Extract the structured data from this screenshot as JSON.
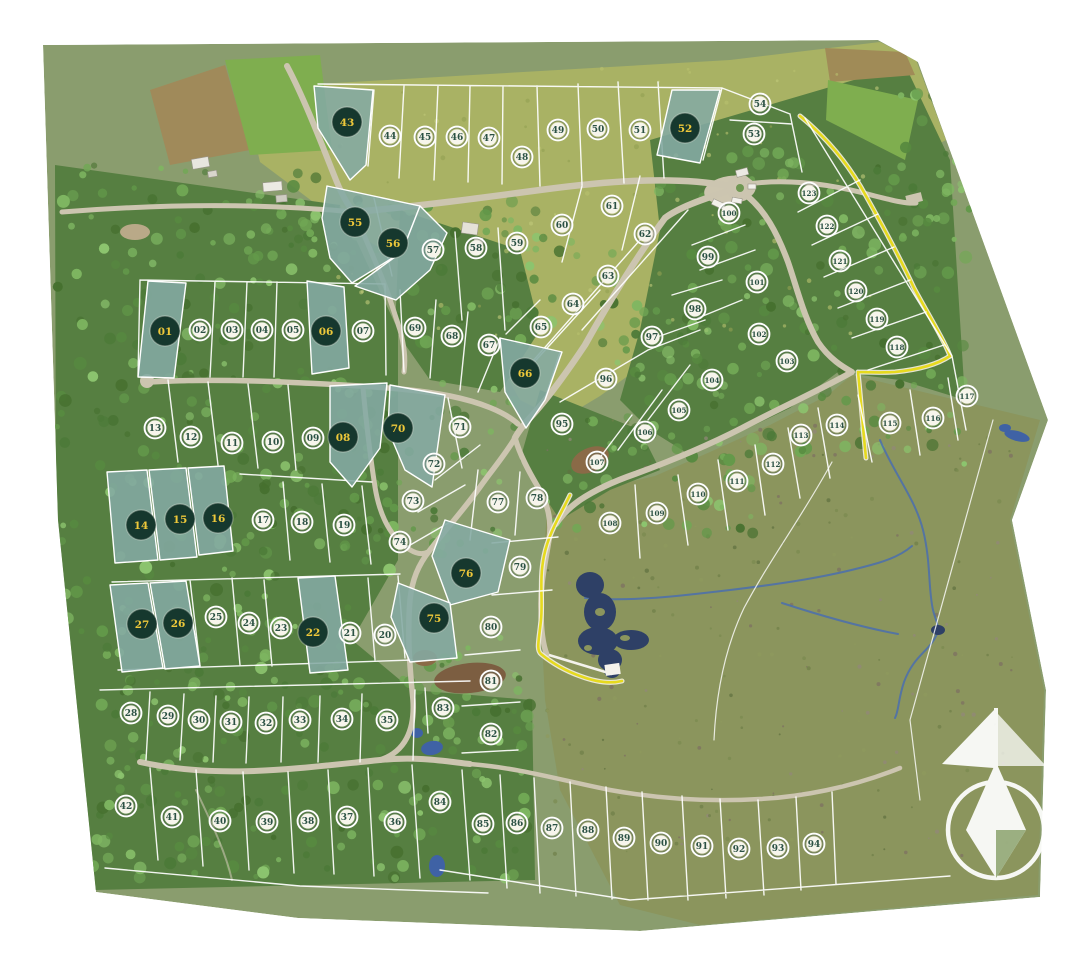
{
  "map": {
    "name": "aerial-subdivision-masterplan",
    "compass_icon": "compass-north-rose",
    "marker_styles": {
      "available": "white circle with dark green lot number",
      "sold": "dark green circle with yellow lot number on teal shaded lot"
    }
  },
  "colors": {
    "sold_overlay": "#84aaa3",
    "sold_marker": "#16382e",
    "sold_number": "#eec83a",
    "available_marker": "#f7f5ec",
    "available_number": "#2b5144",
    "trail": "#e6da1e",
    "water": "#2e4066",
    "stream": "#4a6fae",
    "base_green": "#8a9d6e",
    "forest_green": "#567f41",
    "pasture_green": "#a9b264",
    "moor_green": "#8b955d",
    "road_grey": "#ccc5b0"
  },
  "lots": [
    {
      "id": "01",
      "x": 165,
      "y": 331,
      "status": "sold"
    },
    {
      "id": "02",
      "x": 200,
      "y": 330,
      "status": "available"
    },
    {
      "id": "03",
      "x": 232,
      "y": 330,
      "status": "available"
    },
    {
      "id": "04",
      "x": 262,
      "y": 330,
      "status": "available"
    },
    {
      "id": "05",
      "x": 293,
      "y": 330,
      "status": "available"
    },
    {
      "id": "06",
      "x": 326,
      "y": 331,
      "status": "sold"
    },
    {
      "id": "07",
      "x": 363,
      "y": 331,
      "status": "available"
    },
    {
      "id": "08",
      "x": 343,
      "y": 437,
      "status": "sold"
    },
    {
      "id": "09",
      "x": 313,
      "y": 438,
      "status": "available"
    },
    {
      "id": "10",
      "x": 273,
      "y": 442,
      "status": "available"
    },
    {
      "id": "11",
      "x": 232,
      "y": 443,
      "status": "available"
    },
    {
      "id": "12",
      "x": 191,
      "y": 437,
      "status": "available"
    },
    {
      "id": "13",
      "x": 155,
      "y": 428,
      "status": "available"
    },
    {
      "id": "14",
      "x": 141,
      "y": 525,
      "status": "sold"
    },
    {
      "id": "15",
      "x": 180,
      "y": 519,
      "status": "sold"
    },
    {
      "id": "16",
      "x": 218,
      "y": 518,
      "status": "sold"
    },
    {
      "id": "17",
      "x": 263,
      "y": 520,
      "status": "available"
    },
    {
      "id": "18",
      "x": 302,
      "y": 522,
      "status": "available"
    },
    {
      "id": "19",
      "x": 344,
      "y": 525,
      "status": "available"
    },
    {
      "id": "20",
      "x": 385,
      "y": 635,
      "status": "available"
    },
    {
      "id": "21",
      "x": 350,
      "y": 633,
      "status": "available"
    },
    {
      "id": "22",
      "x": 313,
      "y": 632,
      "status": "sold"
    },
    {
      "id": "23",
      "x": 281,
      "y": 628,
      "status": "available"
    },
    {
      "id": "24",
      "x": 249,
      "y": 623,
      "status": "available"
    },
    {
      "id": "25",
      "x": 216,
      "y": 617,
      "status": "available"
    },
    {
      "id": "26",
      "x": 178,
      "y": 623,
      "status": "sold"
    },
    {
      "id": "27",
      "x": 142,
      "y": 624,
      "status": "sold"
    },
    {
      "id": "28",
      "x": 131,
      "y": 713,
      "status": "available"
    },
    {
      "id": "29",
      "x": 168,
      "y": 716,
      "status": "available"
    },
    {
      "id": "30",
      "x": 199,
      "y": 720,
      "status": "available"
    },
    {
      "id": "31",
      "x": 231,
      "y": 722,
      "status": "available"
    },
    {
      "id": "32",
      "x": 266,
      "y": 723,
      "status": "available"
    },
    {
      "id": "33",
      "x": 300,
      "y": 720,
      "status": "available"
    },
    {
      "id": "34",
      "x": 342,
      "y": 719,
      "status": "available"
    },
    {
      "id": "35",
      "x": 387,
      "y": 720,
      "status": "available"
    },
    {
      "id": "36",
      "x": 395,
      "y": 822,
      "status": "available"
    },
    {
      "id": "37",
      "x": 347,
      "y": 817,
      "status": "available"
    },
    {
      "id": "38",
      "x": 308,
      "y": 821,
      "status": "available"
    },
    {
      "id": "39",
      "x": 267,
      "y": 822,
      "status": "available"
    },
    {
      "id": "40",
      "x": 220,
      "y": 821,
      "status": "available"
    },
    {
      "id": "41",
      "x": 172,
      "y": 817,
      "status": "available"
    },
    {
      "id": "42",
      "x": 126,
      "y": 806,
      "status": "available"
    },
    {
      "id": "43",
      "x": 347,
      "y": 122,
      "status": "sold"
    },
    {
      "id": "44",
      "x": 390,
      "y": 136,
      "status": "available"
    },
    {
      "id": "45",
      "x": 425,
      "y": 137,
      "status": "available"
    },
    {
      "id": "46",
      "x": 457,
      "y": 137,
      "status": "available"
    },
    {
      "id": "47",
      "x": 489,
      "y": 138,
      "status": "available"
    },
    {
      "id": "48",
      "x": 522,
      "y": 157,
      "status": "available"
    },
    {
      "id": "49",
      "x": 558,
      "y": 130,
      "status": "available"
    },
    {
      "id": "50",
      "x": 598,
      "y": 129,
      "status": "available"
    },
    {
      "id": "51",
      "x": 640,
      "y": 130,
      "status": "available"
    },
    {
      "id": "52",
      "x": 685,
      "y": 128,
      "status": "sold"
    },
    {
      "id": "53",
      "x": 754,
      "y": 134,
      "status": "available"
    },
    {
      "id": "54",
      "x": 760,
      "y": 104,
      "status": "available"
    },
    {
      "id": "55",
      "x": 355,
      "y": 222,
      "status": "sold"
    },
    {
      "id": "56",
      "x": 393,
      "y": 243,
      "status": "sold"
    },
    {
      "id": "57",
      "x": 433,
      "y": 250,
      "status": "available"
    },
    {
      "id": "58",
      "x": 476,
      "y": 248,
      "status": "available"
    },
    {
      "id": "59",
      "x": 517,
      "y": 243,
      "status": "available"
    },
    {
      "id": "60",
      "x": 562,
      "y": 225,
      "status": "available"
    },
    {
      "id": "61",
      "x": 612,
      "y": 206,
      "status": "available"
    },
    {
      "id": "62",
      "x": 645,
      "y": 234,
      "status": "available"
    },
    {
      "id": "63",
      "x": 608,
      "y": 276,
      "status": "available"
    },
    {
      "id": "64",
      "x": 573,
      "y": 304,
      "status": "available"
    },
    {
      "id": "65",
      "x": 541,
      "y": 327,
      "status": "available"
    },
    {
      "id": "66",
      "x": 525,
      "y": 373,
      "status": "sold"
    },
    {
      "id": "67",
      "x": 489,
      "y": 345,
      "status": "available"
    },
    {
      "id": "68",
      "x": 452,
      "y": 336,
      "status": "available"
    },
    {
      "id": "69",
      "x": 415,
      "y": 328,
      "status": "available"
    },
    {
      "id": "70",
      "x": 398,
      "y": 428,
      "status": "sold"
    },
    {
      "id": "71",
      "x": 460,
      "y": 427,
      "status": "available"
    },
    {
      "id": "72",
      "x": 434,
      "y": 464,
      "status": "available"
    },
    {
      "id": "73",
      "x": 413,
      "y": 501,
      "status": "available"
    },
    {
      "id": "74",
      "x": 400,
      "y": 542,
      "status": "available"
    },
    {
      "id": "75",
      "x": 434,
      "y": 618,
      "status": "sold"
    },
    {
      "id": "76",
      "x": 466,
      "y": 573,
      "status": "sold"
    },
    {
      "id": "77",
      "x": 498,
      "y": 502,
      "status": "available"
    },
    {
      "id": "78",
      "x": 537,
      "y": 498,
      "status": "available"
    },
    {
      "id": "79",
      "x": 520,
      "y": 567,
      "status": "available"
    },
    {
      "id": "80",
      "x": 491,
      "y": 627,
      "status": "available"
    },
    {
      "id": "81",
      "x": 491,
      "y": 681,
      "status": "available"
    },
    {
      "id": "82",
      "x": 491,
      "y": 734,
      "status": "available"
    },
    {
      "id": "83",
      "x": 443,
      "y": 708,
      "status": "available"
    },
    {
      "id": "84",
      "x": 440,
      "y": 802,
      "status": "available"
    },
    {
      "id": "85",
      "x": 483,
      "y": 824,
      "status": "available"
    },
    {
      "id": "86",
      "x": 517,
      "y": 823,
      "status": "available"
    },
    {
      "id": "87",
      "x": 552,
      "y": 828,
      "status": "available"
    },
    {
      "id": "88",
      "x": 588,
      "y": 830,
      "status": "available"
    },
    {
      "id": "89",
      "x": 624,
      "y": 838,
      "status": "available"
    },
    {
      "id": "90",
      "x": 661,
      "y": 843,
      "status": "available"
    },
    {
      "id": "91",
      "x": 702,
      "y": 846,
      "status": "available"
    },
    {
      "id": "92",
      "x": 739,
      "y": 849,
      "status": "available"
    },
    {
      "id": "93",
      "x": 778,
      "y": 848,
      "status": "available"
    },
    {
      "id": "94",
      "x": 814,
      "y": 844,
      "status": "available"
    },
    {
      "id": "95",
      "x": 562,
      "y": 424,
      "status": "available"
    },
    {
      "id": "96",
      "x": 606,
      "y": 379,
      "status": "available"
    },
    {
      "id": "97",
      "x": 652,
      "y": 337,
      "status": "available"
    },
    {
      "id": "98",
      "x": 695,
      "y": 309,
      "status": "available"
    },
    {
      "id": "99",
      "x": 708,
      "y": 257,
      "status": "available"
    },
    {
      "id": "100",
      "x": 729,
      "y": 213,
      "status": "available"
    },
    {
      "id": "101",
      "x": 757,
      "y": 282,
      "status": "available"
    },
    {
      "id": "102",
      "x": 759,
      "y": 334,
      "status": "available"
    },
    {
      "id": "103",
      "x": 787,
      "y": 361,
      "status": "available"
    },
    {
      "id": "104",
      "x": 712,
      "y": 380,
      "status": "available"
    },
    {
      "id": "105",
      "x": 679,
      "y": 410,
      "status": "available"
    },
    {
      "id": "106",
      "x": 645,
      "y": 432,
      "status": "available"
    },
    {
      "id": "107",
      "x": 597,
      "y": 462,
      "status": "available"
    },
    {
      "id": "108",
      "x": 610,
      "y": 523,
      "status": "available"
    },
    {
      "id": "109",
      "x": 657,
      "y": 513,
      "status": "available"
    },
    {
      "id": "110",
      "x": 698,
      "y": 494,
      "status": "available"
    },
    {
      "id": "111",
      "x": 737,
      "y": 481,
      "status": "available"
    },
    {
      "id": "112",
      "x": 773,
      "y": 464,
      "status": "available"
    },
    {
      "id": "113",
      "x": 801,
      "y": 435,
      "status": "available"
    },
    {
      "id": "114",
      "x": 837,
      "y": 425,
      "status": "available"
    },
    {
      "id": "115",
      "x": 890,
      "y": 423,
      "status": "available"
    },
    {
      "id": "116",
      "x": 933,
      "y": 418,
      "status": "available"
    },
    {
      "id": "117",
      "x": 967,
      "y": 396,
      "status": "available"
    },
    {
      "id": "118",
      "x": 897,
      "y": 347,
      "status": "available"
    },
    {
      "id": "119",
      "x": 877,
      "y": 319,
      "status": "available"
    },
    {
      "id": "120",
      "x": 856,
      "y": 291,
      "status": "available"
    },
    {
      "id": "121",
      "x": 840,
      "y": 261,
      "status": "available"
    },
    {
      "id": "122",
      "x": 827,
      "y": 226,
      "status": "available"
    },
    {
      "id": "123",
      "x": 809,
      "y": 193,
      "status": "available"
    }
  ]
}
